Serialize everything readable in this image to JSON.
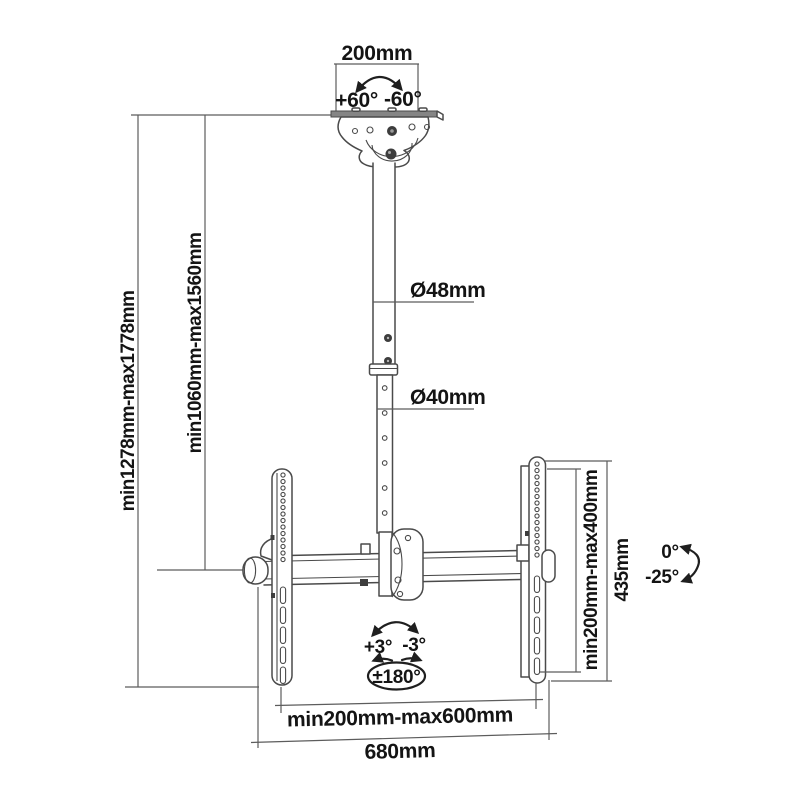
{
  "diagram": {
    "kind": "tv-ceiling-mount-dimension-drawing",
    "background": "#ffffff",
    "colors": {
      "drawing_line": "#4a4a4a",
      "dimension_line": "#5c5c5c",
      "text": "#141414",
      "bolt_fill": "#3d3d3d",
      "plate_shade": "#858585"
    },
    "labels": {
      "ceiling_plate_width": "200mm",
      "swivel_positive": "+60°",
      "swivel_negative": "-60°",
      "upper_pole_diameter": "Ø48mm",
      "lower_pole_diameter": "Ø40mm",
      "overall_height_range": "min1278mm-max1778mm",
      "pole_height_range": "min1060mm-max1560mm",
      "vesa_vertical_range": "min200mm-max400mm",
      "bracket_height": "435mm",
      "tilt_positive": "+3°",
      "tilt_negative": "-3°",
      "rotation_range": "±180°",
      "screen_angle_zero": "0°",
      "screen_angle_tilt": "-25°",
      "vesa_horizontal_range": "min200mm-max600mm",
      "overall_width": "680mm"
    }
  }
}
